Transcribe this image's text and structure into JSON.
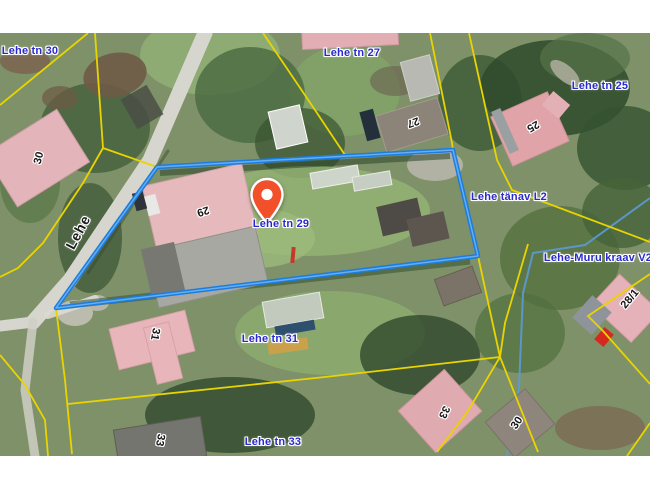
{
  "map": {
    "labels": [
      {
        "text": "Lehe tn 30"
      },
      {
        "text": "Lehe tn 27"
      },
      {
        "text": "Lehe tn 25"
      },
      {
        "text": "Lehe tänav L2"
      },
      {
        "text": "Lehe-Muru kraav V2"
      },
      {
        "text": "Lehe tn 29"
      },
      {
        "text": "Lehe tn 31"
      },
      {
        "text": "Lehe tn 33"
      }
    ],
    "street_label": {
      "text": "Lehe"
    },
    "building_numbers": [
      {
        "text": "30"
      },
      {
        "text": "29"
      },
      {
        "text": "27"
      },
      {
        "text": "25"
      },
      {
        "text": "31"
      },
      {
        "text": "33"
      },
      {
        "text": "33"
      },
      {
        "text": "30"
      },
      {
        "text": "28/1"
      }
    ],
    "marker": {
      "address": "Lehe tn 29"
    },
    "colors": {
      "parcel_highlight": "#1b7de0",
      "cadastral_line": "#e9d400",
      "label_blue": "#2a2acc",
      "marker_fill": "#f1502b",
      "stream": "#5b9bd5"
    }
  }
}
